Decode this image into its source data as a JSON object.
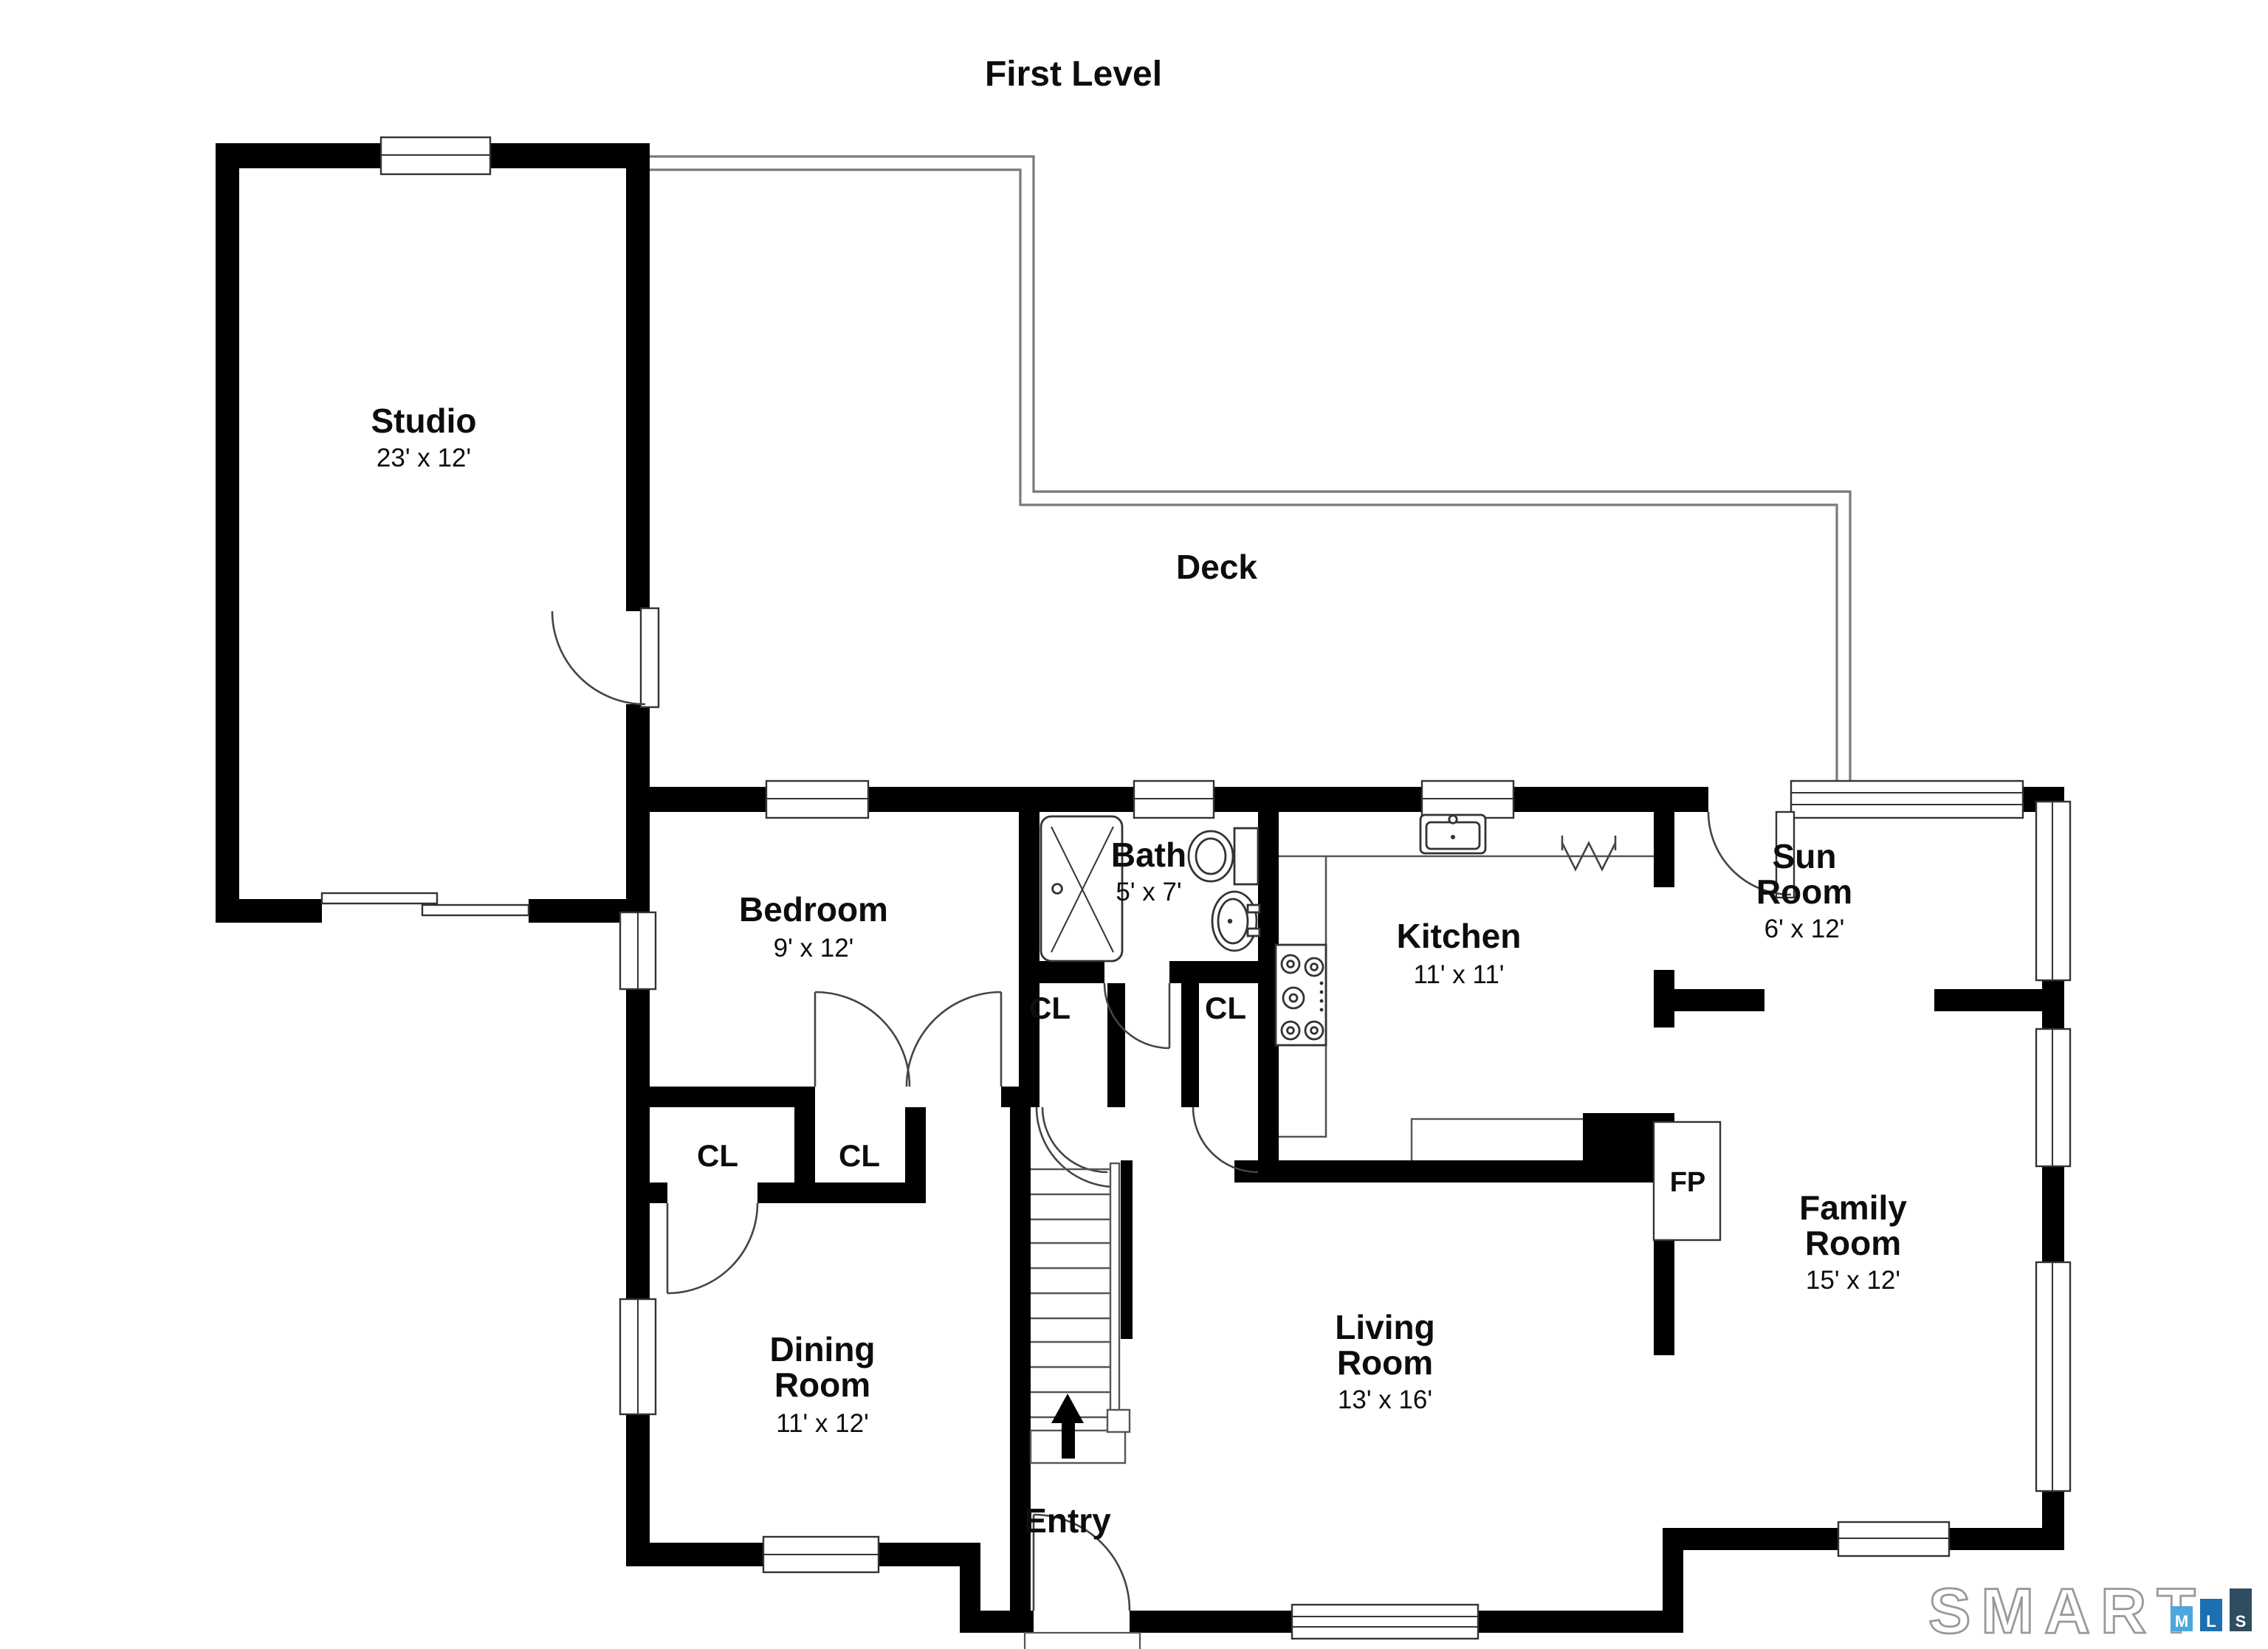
{
  "title": "First Level",
  "rooms": {
    "studio": {
      "name": "Studio",
      "dims": "23' x 12'"
    },
    "deck": {
      "name": "Deck"
    },
    "bedroom": {
      "name": "Bedroom",
      "dims": "9' x 12'"
    },
    "bath": {
      "name": "Bath",
      "dims": "5' x 7'"
    },
    "kitchen": {
      "name": "Kitchen",
      "dims": "11' x 11'"
    },
    "sunroom": {
      "lines": [
        "Sun",
        "Room"
      ],
      "dims": "6' x 12'"
    },
    "family": {
      "lines": [
        "Family",
        "Room"
      ],
      "dims": "15' x 12'"
    },
    "dining": {
      "lines": [
        "Dining",
        "Room"
      ],
      "dims": "11' x 12'"
    },
    "living": {
      "lines": [
        "Living",
        "Room"
      ],
      "dims": "13' x 16'"
    },
    "entry": {
      "name": "Entry"
    }
  },
  "labels": {
    "fireplace": "FP",
    "closets": [
      "CL",
      "CL",
      "CL",
      "CL"
    ]
  },
  "stairs": {
    "direction_icon": "up-arrow"
  },
  "logo": {
    "word": "SMART",
    "bars": [
      {
        "letter": "M",
        "color": "#4BA7DC"
      },
      {
        "letter": "L",
        "color": "#1E6FAF"
      },
      {
        "letter": "S",
        "color": "#2E4D60"
      }
    ],
    "outline_color": "#999999"
  },
  "colors": {
    "wall": "#000000",
    "deck_line": "#7a7a7a",
    "background": "#ffffff"
  }
}
